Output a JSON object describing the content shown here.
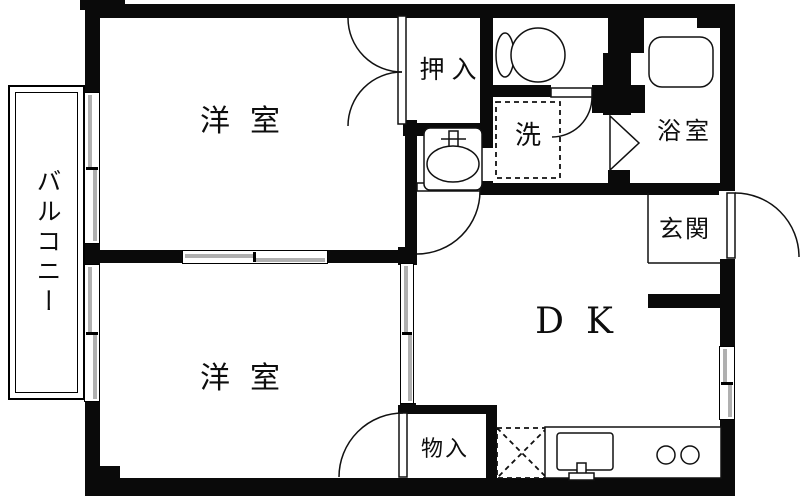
{
  "colors": {
    "wall": "#0a0a0a",
    "floor": "#ffffff",
    "window_pane": "#b0b0b0",
    "line": "#111111"
  },
  "labels": {
    "balcony": "バルコニー",
    "bedroom_top": "洋室",
    "closet": "押入",
    "laundry": "洗",
    "bathroom": "浴室",
    "entrance": "玄関",
    "dining_kitchen": "DK",
    "bedroom_bottom": "洋室",
    "storage": "物入"
  },
  "fixtures": {
    "toilet": "toilet-bowl-and-tank",
    "bathtub": "bathtub",
    "washbasin": "washbasin-with-faucet",
    "kitchen_sink": "kitchen-sink-with-faucet",
    "stove": "two-burner-stove",
    "washer_space": "washing-machine-space-dashed",
    "fridge_space": "refrigerator-space-dashed-x"
  }
}
